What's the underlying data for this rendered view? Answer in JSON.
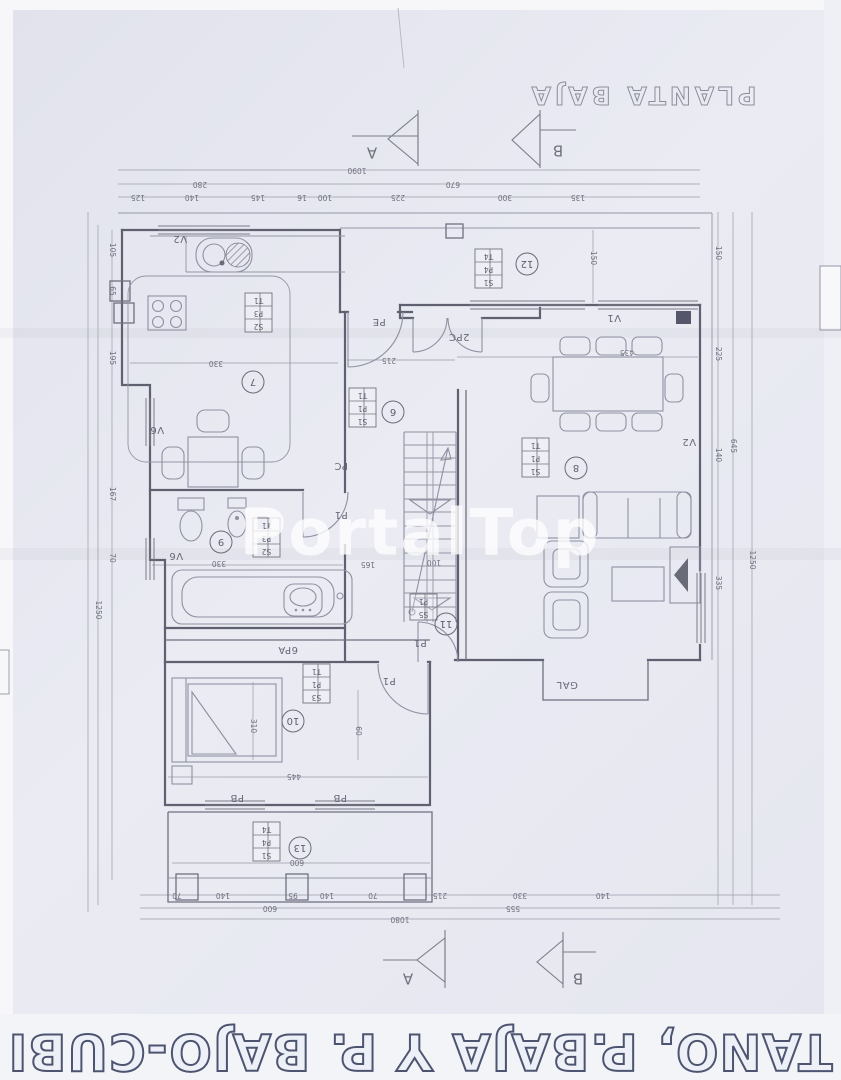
{
  "texts": {
    "plan_title": "PLANTA BAJA",
    "banner": "TANO, P.BAJA Y P. BAJO-CUBI",
    "watermark": "PortalTop"
  },
  "sections": {
    "a": "A",
    "b": "B"
  },
  "room_numbers": {
    "kitchen": "7",
    "hall": "6",
    "living": "8",
    "bath": "9",
    "bedroom": "10",
    "stairs": "11",
    "terrace": "12",
    "porch": "13"
  },
  "labels": {
    "v1": "V1",
    "v2": "V2",
    "v6": "V6",
    "pb": "PB",
    "pc": "PC",
    "p1": "P1",
    "pe": "PE",
    "pc2": "2PC",
    "pa6": "6PA",
    "gal": "GAL"
  },
  "schedules": {
    "kitchen": [
      "S2",
      "P3",
      "T1"
    ],
    "hall": [
      "S1",
      "P1",
      "T1"
    ],
    "living": [
      "S1",
      "P1",
      "T1"
    ],
    "bath": [
      "S2",
      "P3",
      "T1"
    ],
    "bedroom": [
      "S3",
      "P1",
      "T1"
    ],
    "stairs": [
      "S5",
      "P1"
    ],
    "terrace": [
      "S1",
      "P4",
      "T4"
    ],
    "porch": [
      "S1",
      "P4",
      "T4"
    ]
  },
  "dims": {
    "top_total": "1090",
    "top_mid": [
      "280",
      "670"
    ],
    "top_detail": [
      "125",
      "140",
      "145",
      "16",
      "100",
      "225",
      "300",
      "135"
    ],
    "bottom_detail": [
      "70",
      "140",
      "95",
      "140",
      "70",
      "215",
      "330",
      "140"
    ],
    "bottom_mid": [
      "600",
      "555"
    ],
    "bottom_total": "1080",
    "left": [
      "105",
      "65",
      "195",
      "167",
      "70",
      "1250"
    ],
    "right": [
      "150",
      "225",
      "140",
      "645",
      "335",
      "1250"
    ],
    "inner": {
      "kitchen": "330",
      "hall": "215",
      "dining": "435",
      "bath": "330",
      "bedroom": "445",
      "bedroom_v": "310",
      "bedroom_v2": "60",
      "porch": "600",
      "terrace_v": "150",
      "stairs_a": "165",
      "stairs_b": "100"
    }
  }
}
